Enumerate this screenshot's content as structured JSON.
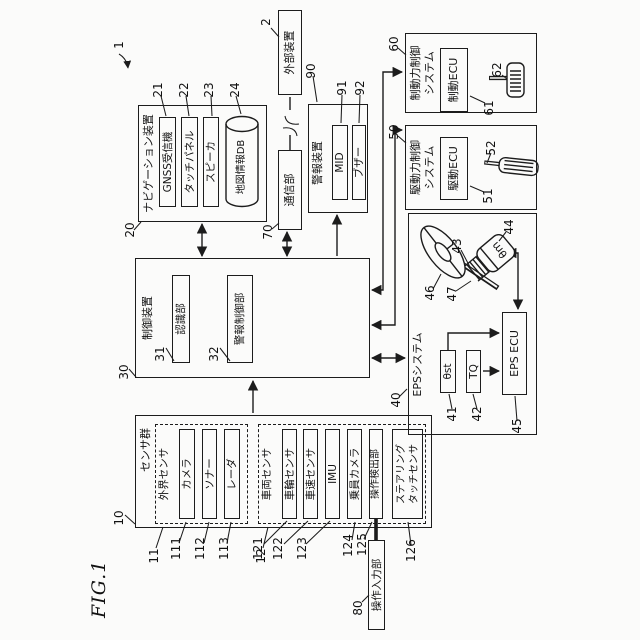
{
  "figure": {
    "label": "FIG.1",
    "system_ref": "1"
  },
  "external_device": {
    "ref": "2",
    "label": "外部装置"
  },
  "communication": {
    "ref": "70",
    "label": "通信部"
  },
  "navigation": {
    "ref": "20",
    "label": "ナビゲーション装置",
    "gnss": {
      "ref": "21",
      "label": "GNSS受信機"
    },
    "touch_panel": {
      "ref": "22",
      "label": "タッチパネル"
    },
    "speaker": {
      "ref": "23",
      "label": "スピーカ"
    },
    "map_db": {
      "ref": "24",
      "label": "地図情報DB"
    }
  },
  "alarm_device": {
    "ref": "90",
    "label": "警報装置",
    "mid": {
      "ref": "91",
      "label": "MID"
    },
    "buzzer": {
      "ref": "92",
      "label": "ブザー"
    }
  },
  "control_device": {
    "ref": "30",
    "label": "制御装置",
    "recognition": {
      "ref": "31",
      "label": "認識部"
    },
    "alarm_control": {
      "ref": "32",
      "label": "警報制御部"
    }
  },
  "sensor_group": {
    "ref": "10",
    "label": "センサ群",
    "external_sensors": {
      "ref": "11",
      "label": "外界センサ",
      "camera": {
        "ref": "111",
        "label": "カメラ"
      },
      "sonar": {
        "ref": "112",
        "label": "ソナー"
      },
      "radar": {
        "ref": "113",
        "label": "レーダ"
      }
    },
    "vehicle_sensors": {
      "ref": "12",
      "label": "車両センサ",
      "wheel_sensor": {
        "ref": "121",
        "label": "車輪センサ"
      },
      "speed_sensor": {
        "ref": "122",
        "label": "車速センサ"
      },
      "imu": {
        "ref": "123",
        "label": "IMU"
      },
      "occupant_camera": {
        "ref": "124",
        "label": "乗員カメラ"
      },
      "operation_detector": {
        "ref": "125",
        "label": "操作検出部"
      },
      "steering_touch_sensor": {
        "ref": "126",
        "label_line1": "ステアリング",
        "label_line2": "タッチセンサ"
      }
    }
  },
  "operation_input": {
    "ref": "80",
    "label": "操作入力部"
  },
  "eps_system": {
    "ref": "40",
    "label": "EPSシステム",
    "steering_angle": {
      "ref": "41",
      "label": "θst"
    },
    "torque": {
      "ref": "42",
      "label": "TQ"
    },
    "eps_ecu": {
      "ref": "45",
      "label": "EPS ECU"
    },
    "motor": {
      "ref": "43"
    },
    "motor_angle": {
      "ref": "44",
      "label": "θm"
    },
    "steering_wheel": {
      "ref": "46"
    },
    "steering_shaft": {
      "ref": "47"
    }
  },
  "drive_system": {
    "ref": "50",
    "label_line1": "駆動力制御",
    "label_line2": "システム",
    "drive_ecu": {
      "ref": "51",
      "label": "駆動ECU"
    },
    "accel_pedal": {
      "ref": "52"
    }
  },
  "brake_system": {
    "ref": "60",
    "label_line1": "制動力制御",
    "label_line2": "システム",
    "brake_ecu": {
      "ref": "61",
      "label": "制動ECU"
    },
    "brake_pedal": {
      "ref": "62"
    }
  },
  "colors": {
    "line": "#1c1c1c",
    "background": "#fbfbfa"
  }
}
